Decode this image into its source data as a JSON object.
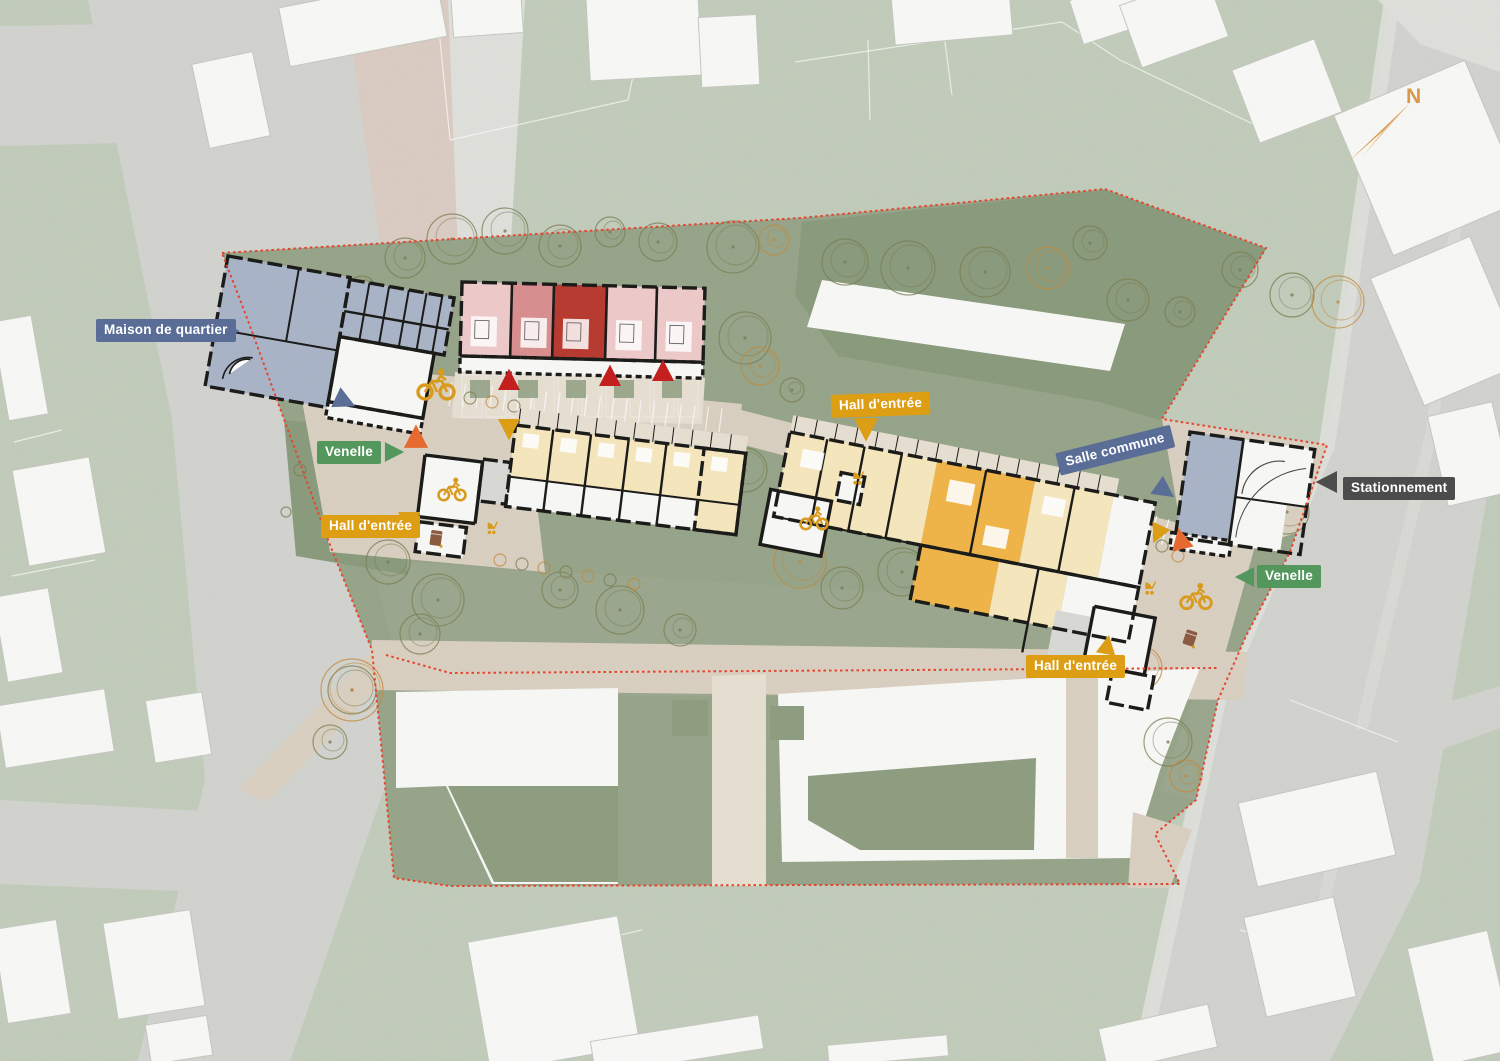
{
  "annotations": {
    "maison_de_quartier": {
      "label": "Maison de quartier",
      "color_key": "label_blue"
    },
    "venelle_left": {
      "label": "Venelle",
      "color_key": "label_green"
    },
    "hall_entree_left": {
      "label": "Hall d'entrée",
      "color_key": "label_amber"
    },
    "hall_entree_top": {
      "label": "Hall d'entrée",
      "color_key": "label_amber"
    },
    "salle_commune": {
      "label": "Salle commune",
      "color_key": "label_blue"
    },
    "stationnement": {
      "label": "Stationnement",
      "color_key": "label_dark"
    },
    "venelle_right": {
      "label": "Venelle",
      "color_key": "label_green"
    },
    "hall_entree_bottom": {
      "label": "Hall d'entrée",
      "color_key": "label_amber"
    },
    "north_arrow": {
      "label": "N",
      "color_key": "north_orange"
    }
  },
  "palette": {
    "context_green": "#c2ccbb",
    "site_green": "#96a489",
    "north_green": "#8a9a7c",
    "lawn_green": "#9aa78d",
    "court_green": "#8e9d80",
    "road_gray": "#d2d3cf",
    "road_light": "#dfe0db",
    "sidewalk_pink": "#dbccc3",
    "paving": "#d9d0c2",
    "paving_light": "#e6dfd2",
    "building_white": "#f8f8f6",
    "outline_gray": "#c6c7c1",
    "wall_black": "#191917",
    "slate": "#a9b4c8",
    "pink_light": "#eecaca",
    "pink_mid": "#d98e8e",
    "red_dark": "#b8392f",
    "cream": "#f6e7bd",
    "amber": "#f0b548",
    "gray_room": "#d8d9d5",
    "label_blue": "#5a6d97",
    "label_green": "#53975d",
    "label_amber": "#dd9e14",
    "label_dark": "#4c4c4c",
    "boundary_red": "#e8432b",
    "tri_red": "#c51d1d",
    "tri_orange": "#e8692f",
    "tree_olive": "#7a7d52",
    "tree_orange": "#c18a3c",
    "icon_amber": "#d99b1c",
    "bin_brown": "#8a5a3f",
    "north_orange": "#d9984a",
    "north_orange_light": "#ecc49c"
  },
  "icons": {
    "bike": "bike-icon",
    "stroller": "stroller-icon",
    "waste_bin": "bin-icon",
    "north": "north-arrow-icon",
    "entrance": "entrance-triangle"
  }
}
